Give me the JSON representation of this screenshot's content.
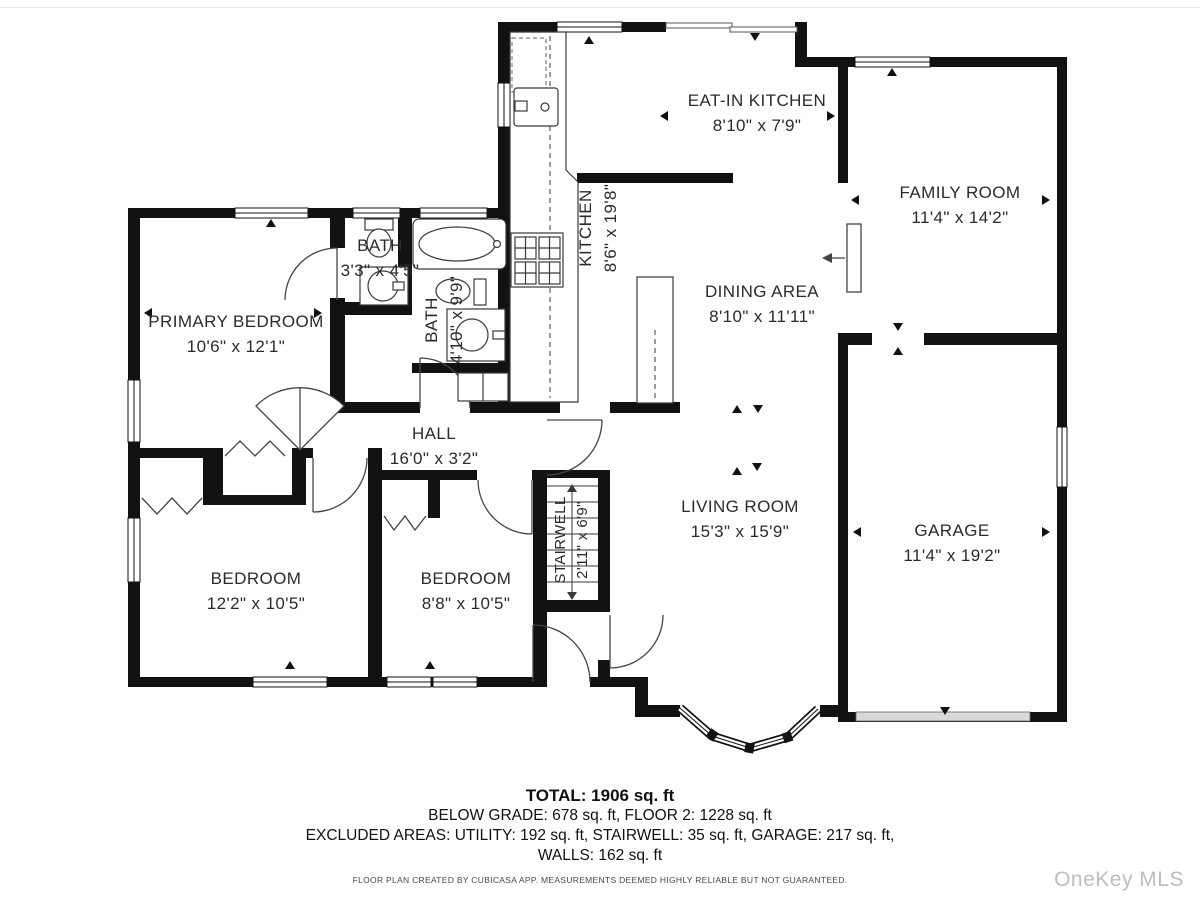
{
  "floor_plan": {
    "rooms": [
      {
        "id": "eat_in_kitchen",
        "name": "EAT-IN KITCHEN",
        "dims": "8'10\" x 7'9\""
      },
      {
        "id": "family_room",
        "name": "FAMILY ROOM",
        "dims": "11'4\" x 14'2\""
      },
      {
        "id": "kitchen",
        "name": "KITCHEN",
        "dims": "8'6\" x 19'8\""
      },
      {
        "id": "dining_area",
        "name": "DINING AREA",
        "dims": "8'10\" x 11'11\""
      },
      {
        "id": "bath_small",
        "name": "BATH",
        "dims": "3'3\" x 4'5\""
      },
      {
        "id": "bath_hall",
        "name": "BATH",
        "dims": "4'10\" x 9'9\""
      },
      {
        "id": "primary_bedroom",
        "name": "PRIMARY BEDROOM",
        "dims": "10'6\" x 12'1\""
      },
      {
        "id": "hall",
        "name": "HALL",
        "dims": "16'0\" x 3'2\""
      },
      {
        "id": "stairwell",
        "name": "STAIRWELL",
        "dims": "2'11\" x 6'9\""
      },
      {
        "id": "living_room",
        "name": "LIVING ROOM",
        "dims": "15'3\" x 15'9\""
      },
      {
        "id": "garage",
        "name": "GARAGE",
        "dims": "11'4\" x 19'2\""
      },
      {
        "id": "bedroom_left",
        "name": "BEDROOM",
        "dims": "12'2\" x 10'5\""
      },
      {
        "id": "bedroom_right",
        "name": "BEDROOM",
        "dims": "8'8\" x 10'5\""
      }
    ],
    "summary": {
      "total": "TOTAL: 1906 sq. ft",
      "line2": "BELOW GRADE: 678 sq. ft, FLOOR 2: 1228 sq. ft",
      "line3": "EXCLUDED AREAS: UTILITY: 192 sq. ft, STAIRWELL: 35 sq. ft, GARAGE: 217 sq. ft,",
      "line4": "WALLS: 162 sq. ft"
    },
    "disclaimer": "FLOOR PLAN CREATED BY CUBICASA APP. MEASUREMENTS DEEMED HIGHLY RELIABLE BUT NOT GUARANTEED.",
    "watermark": "OneKey MLS",
    "colors": {
      "wall": "#121212",
      "watermark": "#bdbdbd"
    }
  }
}
